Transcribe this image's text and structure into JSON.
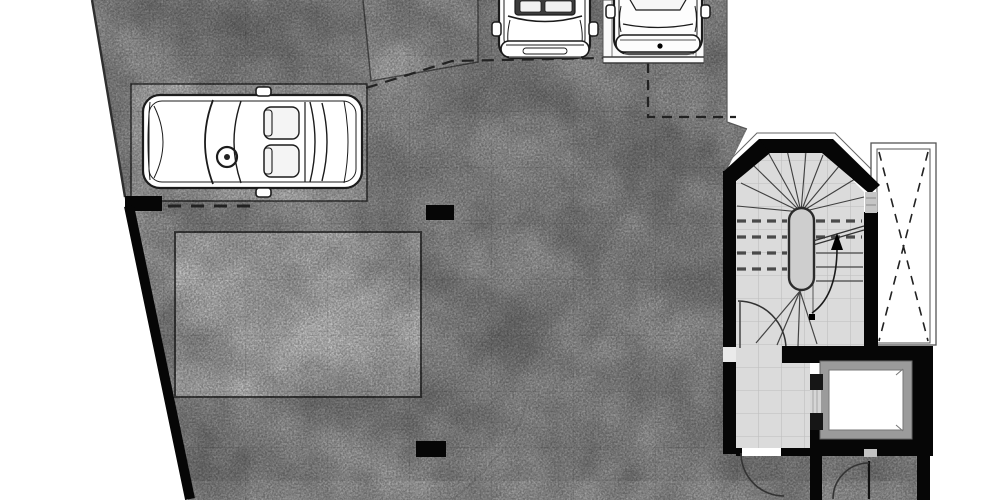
{
  "canvas": {
    "width": 1000,
    "height": 500,
    "background": "#ffffff"
  },
  "colors": {
    "outside": "#ffffff",
    "floor_concrete": "#a9a9a9",
    "ramp_surface": "#b9b9b9",
    "parking_stall": "#c6c6c6",
    "skylight_panel": "#d2d2d2",
    "bay_white": "#fafafa",
    "lobby_tile": "#dbdbdb",
    "tile_grout": "#bdbdbd",
    "wall_black": "#060606",
    "newel_fill": "#cecece",
    "elevator_frame": "#9b9b9b",
    "elevator_interior": "#ffffff",
    "opening_shade": "#c6c6c6",
    "threshold": "#eaeaea",
    "door_notch": "#c2c2c2",
    "line_dark": "#2e2e2e",
    "dash_dark": "#222222"
  },
  "plan": {
    "kind": "floor plan of parking level with stair and elevator core",
    "text_labels": [],
    "cars": [
      {
        "view": "top plan view",
        "location": "left parking stall, nose facing left"
      },
      {
        "view": "front view",
        "location": "top center bay, facing down"
      },
      {
        "view": "rear view",
        "location": "top right white bay, facing down"
      }
    ],
    "columns": {
      "count": 2
    },
    "stair": {
      "style": "winder stair in chamfered black-wall enclosure",
      "newel": "oval center newel",
      "overhead_flight": "dashed tread lines",
      "direction_arrow": "curved arrow from square start dot, pointing up"
    },
    "elevator": {
      "present": true,
      "door_side": "left"
    },
    "doors": {
      "swing_arcs": 3
    },
    "shaft": {
      "marking": "dashed X brace"
    },
    "overhead_outlines": {
      "dashed_polylines": 2
    }
  }
}
